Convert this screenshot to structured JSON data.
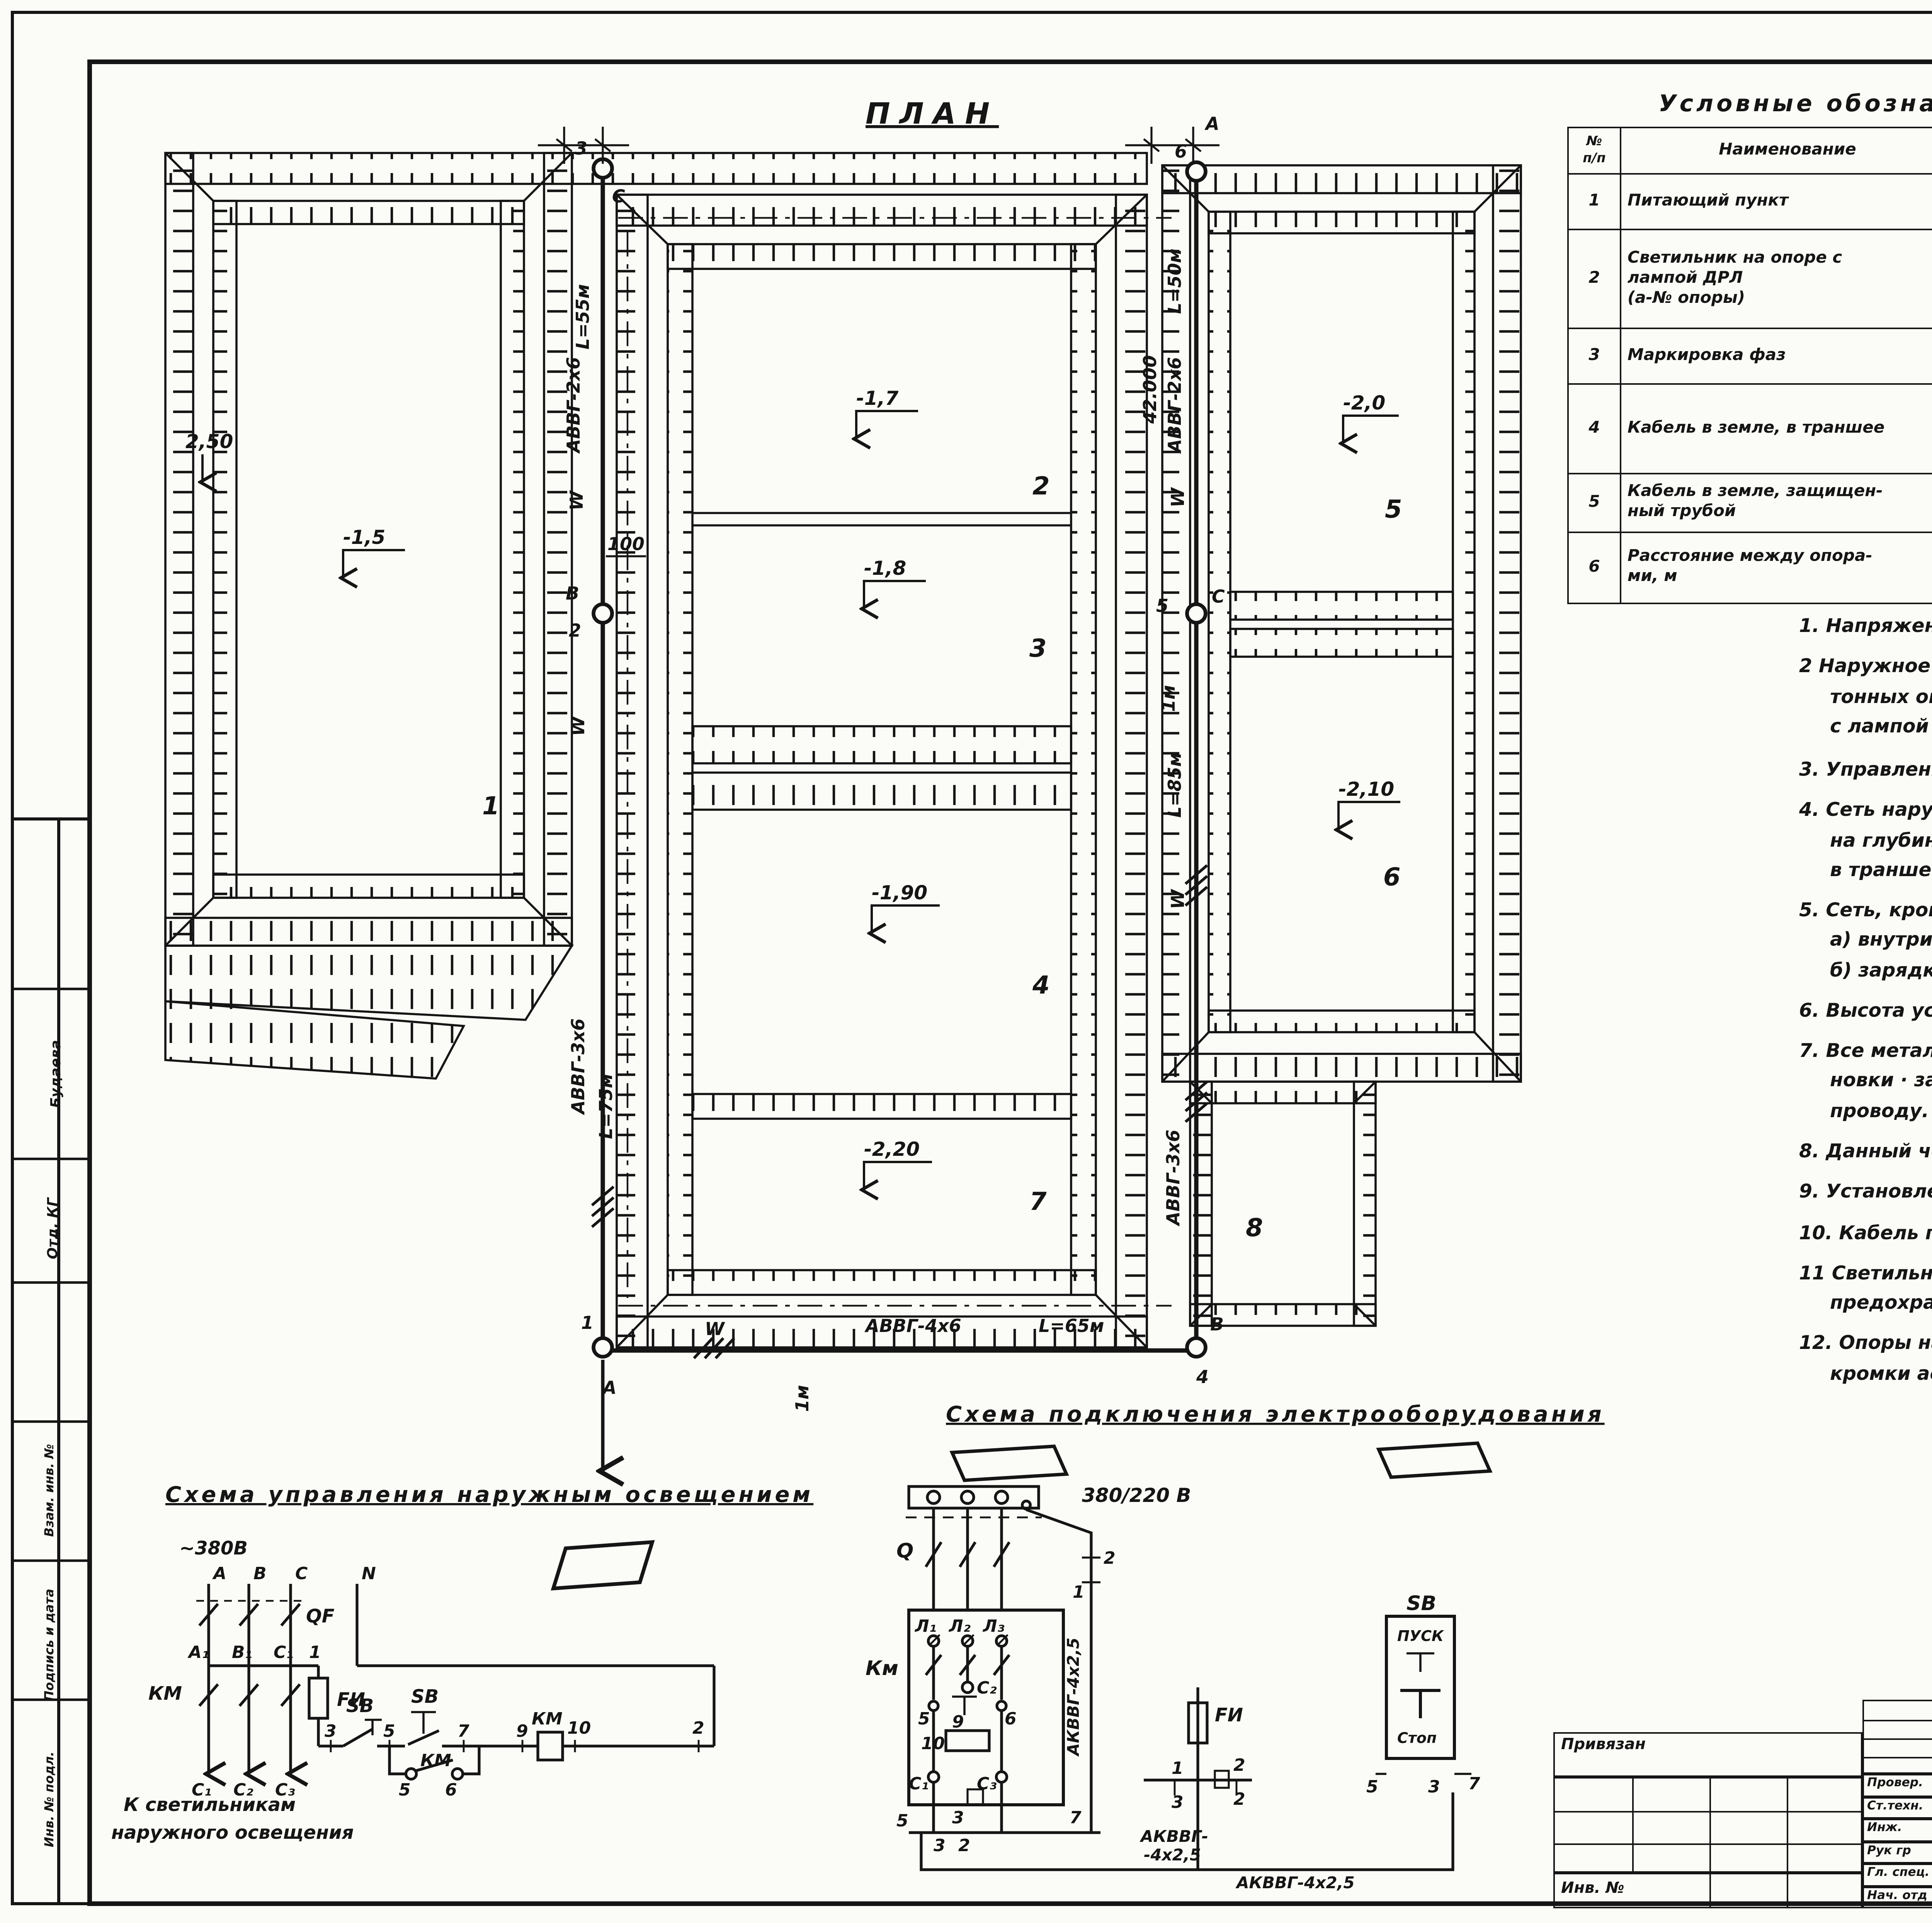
{
  "misc": {
    "period": ".",
    "corner": "16,"
  },
  "plan": {
    "title": "ПЛАН",
    "lab": {
      "p1": "1",
      "p2": "2",
      "p3": "3",
      "p4": "4",
      "p5": "5",
      "p6": "6",
      "p7": "7",
      "p8": "8",
      "d1": "-1,5",
      "d2": "-1,7",
      "d3": "-1,8",
      "d4": "-1,90",
      "d5": "-2,0",
      "d6": "-2,10",
      "d7": "-2,20",
      "lvl": "2,50",
      "pole1": "1",
      "pole2": "2",
      "pole3": "3",
      "pole4": "4",
      "pole5": "5",
      "pole6": "6",
      "phA_top": "А",
      "phC_top": "С",
      "phB_mid": "В",
      "phA_bot": "А",
      "phB_bot": "В",
      "phC_mid": "С",
      "c2x6a": "АВВГ-2х6",
      "len55": "L=55м",
      "w1": "W",
      "dim100": "100",
      "w2": "W",
      "c3x6a": "АВВГ-3х6",
      "len75": "L=75м",
      "ch42": "42.000",
      "c2x6b": "АВВГ-2х6",
      "len50": "L=50м",
      "w3": "W",
      "dim1ma": "1м",
      "len85": "L=85м",
      "w4": "W",
      "c3x6b": "АВВГ-3х6",
      "c4x6": "АВВГ-4х6",
      "len65": "L=65м",
      "w5": "W",
      "dim1mb": "1м"
    }
  },
  "legend": {
    "title": "Условные   обозначения",
    "h_num": "№\nп/п",
    "h_name": "Наименование",
    "h_sym": "Обозначение",
    "r1n": "1",
    "r1": "Питающий   пункт",
    "r2n": "2",
    "r2": "Светильник  на  опоре  с\nлампой  ДРЛ\n(а-№  опоры)",
    "r2sym": "a",
    "r3n": "3",
    "r3": "Маркировка  фаз",
    "r3sym": "А, В, С",
    "r4n": "4",
    "r4": "Кабель  в земле, в траншее",
    "r4sym": "W",
    "r5n": "5",
    "r5": "Кабель  в земле, защищен-\nный  трубой",
    "r6n": "6",
    "r6": "Расстояние  между  опора-\nми,   м",
    "r6sym": "L"
  },
  "explication": {
    "title": "Экспликация",
    "h_num": "№\nпо ген",
    "h_name": "Наименование",
    "rows": [
      {
        "num": "1",
        "name": "Аэрируемый  пруд  очистки  I ступени"
      },
      {
        "num": "2",
        "name": "Аэрируемый  биопруд  очистки  II ступени"
      },
      {
        "num": "3",
        "name": "Аэрируемый  биопруд  очистки  III ступени"
      },
      {
        "num": "4",
        "name": "Аэрируемый  биопруд  очистки  IV ступени"
      },
      {
        "num": "5",
        "name": "Аэрируемый  биопруд  доочистки  I ступени"
      },
      {
        "num": "6",
        "name": "Аэрируемый  биопруд  доочистки  II ступени"
      },
      {
        "num": "7",
        "name": "Контактная   емкость"
      }
    ]
  },
  "notes": [
    "1.  Напряжение   сети   380/220в.",
    "2  Наружное  освещение  территории  запроектировано  на железобе-\nтонных  опорах  типа  СЦс-0,65-8  светильниками  РКУ01-250/623-04\nс лампой  ДРЛ.",
    "3.  Управление  наружным  освещением  производится  из",
    "4.  Сеть  наружного  освещения  выполнена  кабелем  АВВГ-660  в земле\nна глубине  0,7м  от планировочной  отметки.  Прокладку  кабелей\nв траншее   см.  типовой   проект  4.407-251.",
    "5.  Сеть,  кроме  отмеченной,  выполнить:\nа)  внутри  опор  с кабельным  вводом — проводом  АПВ-2(1х2,5)мм²\nб)  зарядку  светильников — проводом  ПРГ-2(1х1,5) мм².",
    "6.  Высота  установки  светильников  на  опорах ~8,5м",
    "7.  Все  металлические  нетоковедущие  части  осветительной  уста-\nновки · заземлить  присоединением  к  рабочему  нулевому\nпроводу.",
    "8.  Данный  чертеж  выполнен  на основании  генплана  ГП-1.",
    "9.  Установленная   мощность ~1,5 квт",
    "10. Кабель  под  дорогой  проложить  в асбестоцементных  трубах.",
    "11  Светильники  на  опорах  присоединяются  к сети  через\nпредохранители.",
    "12. Опоры  наружного  освещения  установить  на  0,7 м  от\nкромки  асфальта."
  ],
  "s1": {
    "title": "Схема  управления  наружным  освещением",
    "v380": "~380В",
    "nA": "А",
    "nB": "В",
    "nC": "С",
    "nN": "N",
    "qf": "QF",
    "a1": "А₁",
    "b1": "В₁",
    "c1": "С₁",
    "n1": "1",
    "km1": "КМ",
    "fi": "FИ",
    "cc1": "С₁",
    "cc2": "С₂",
    "cc3": "С₃",
    "n3": "3",
    "sb1": "SB",
    "n5": "5",
    "sb2": "SB",
    "n7": "7",
    "n9": "9",
    "km2": "КМ",
    "n10": "10",
    "n2": "2",
    "kma": "КМ",
    "n5b": "5",
    "n6b": "6",
    "cap1": "К  светильникам",
    "cap2": "наружного  освещения"
  },
  "s2": {
    "title": "Схема  подключения  электрооборудования",
    "v380": "380/220 В",
    "q": "Q",
    "km": "Км",
    "l1": "Л₁",
    "l2": "Л₂",
    "l3": "Л₃",
    "c2": "С₂",
    "k5": "5",
    "k9": "9",
    "k6": "6",
    "k10": "10",
    "cc1": "С₁",
    "cc3": "С₃",
    "b5": "5",
    "b3": "3",
    "b7": "7",
    "b3b": "3",
    "b2b": "2",
    "t1": "2",
    "t2": "1",
    "fi": "FИ",
    "f1": "1",
    "f2": "2",
    "f3": "3",
    "f2b": "2",
    "cab1": "АКВВГ-4х2,5",
    "cab2a": "АКВВГ-",
    "cab2b": "-4х2,5",
    "cab3": "АКВВГ-4х2,5",
    "sb": "SB",
    "pusk": "ПУСК",
    "stop": "Стоп",
    "s5": "5",
    "s3": "3",
    "s7": "7"
  },
  "tb": {
    "doc": "Т.П.902-3-11",
    "code": "ЭЛ",
    "project": "Аэрируемые  биопруды  производительностью 1400м³/сут.  при  БПК полн. ~400 мг/л  с пневматической  аэрацией.",
    "stage_l": "Стадия",
    "sheet_l": "Лист",
    "sheets_l": "Листов",
    "stage": "Р",
    "sheet": "2",
    "sheets": "",
    "title1": "Наружное  освещение",
    "title2": "План.",
    "org1": "ЦНИИЭП",
    "org2": "инженерного оборудования",
    "org3": "г. Москва .",
    "privyazan": "Привязан",
    "inv": "Инв. №",
    "rows": [
      {
        "role": "Провер.",
        "name": "Смердова"
      },
      {
        "role": "Ст.техн.",
        "name": "Садым"
      },
      {
        "role": "Инж.",
        "name": "Панфилова"
      },
      {
        "role": "Рук гр",
        "name": "Смердова"
      },
      {
        "role": "Гл. спец.",
        "name": "Степаненко"
      },
      {
        "role": "Нач. отд",
        "name": "Гольцман"
      }
    ],
    "hand": "16960-01",
    "hand2": "19"
  },
  "margin": {
    "m1": "Будаева",
    "m2": "Отд.  КГ",
    "m3": "Взам. инв. №",
    "m4": "Подпись и дата",
    "m5": "Инв. № подл."
  }
}
